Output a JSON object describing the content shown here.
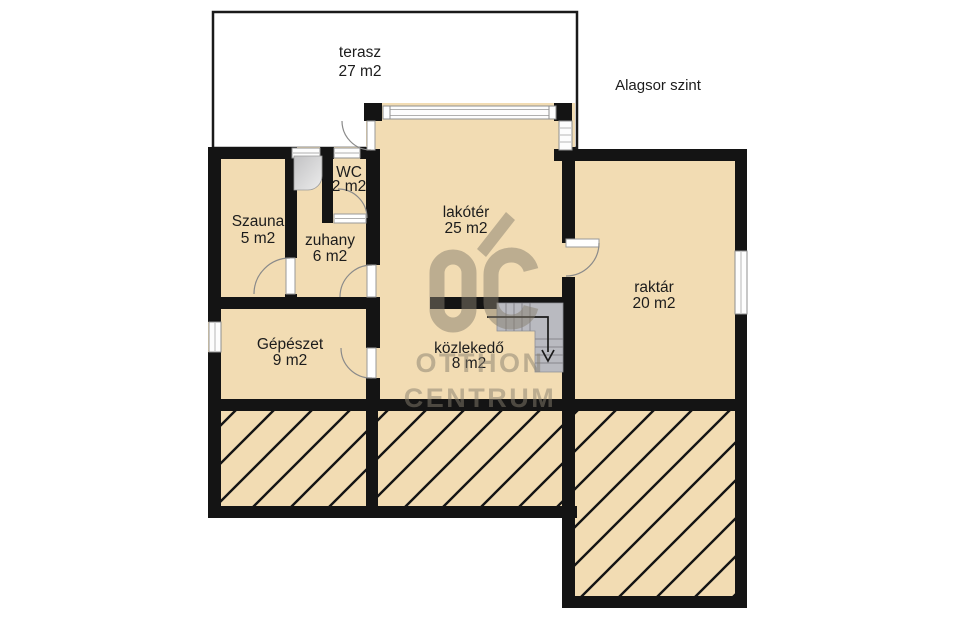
{
  "floor_title": "Alagsor szint",
  "rooms": {
    "terasz": {
      "name": "terasz",
      "area": "27 m2"
    },
    "szauna": {
      "name": "Szauna",
      "area": "5 m2"
    },
    "wc": {
      "name": "WC",
      "area": "2 m2"
    },
    "zuhany": {
      "name": "zuhany",
      "area": "6 m2"
    },
    "lakoter": {
      "name": "lakótér",
      "area": "25 m2"
    },
    "raktar": {
      "name": "raktár",
      "area": "20 m2"
    },
    "gepeszet": {
      "name": "Gépészet",
      "area": "9 m2"
    },
    "kozlekedo": {
      "name": "közlekedő",
      "area": "8 m2"
    }
  },
  "watermark": {
    "monogram": "OC",
    "line1": "OTTHON",
    "line2": "CENTRUM"
  },
  "symbols": {
    "stairs_arrow_direction": "down"
  },
  "colors": {
    "room_fill": "#f2dcb3",
    "wall": "#141414",
    "terrace_fill": "#ffffff",
    "stair_fill": "#b9bac0",
    "watermark": "#877f6f",
    "hatch_line": "#141414"
  }
}
